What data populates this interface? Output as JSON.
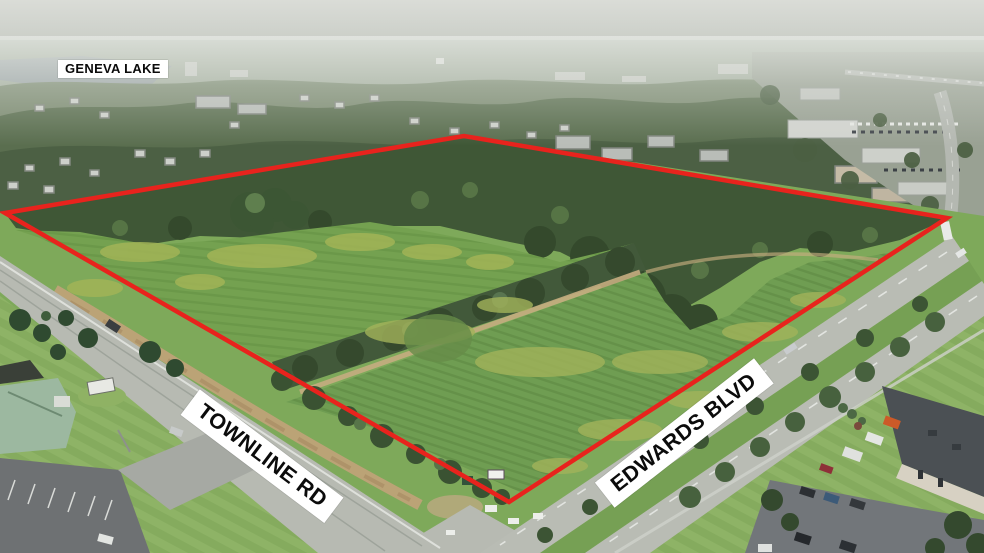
{
  "labels": {
    "lake": "GENEVA LAKE",
    "road_left": "TOWNLINE RD",
    "road_right": "EDWARDS BLVD"
  },
  "colors": {
    "boundary_red": "#e8231d",
    "label_background": "#ffffff",
    "label_text": "#0b0b0b"
  }
}
